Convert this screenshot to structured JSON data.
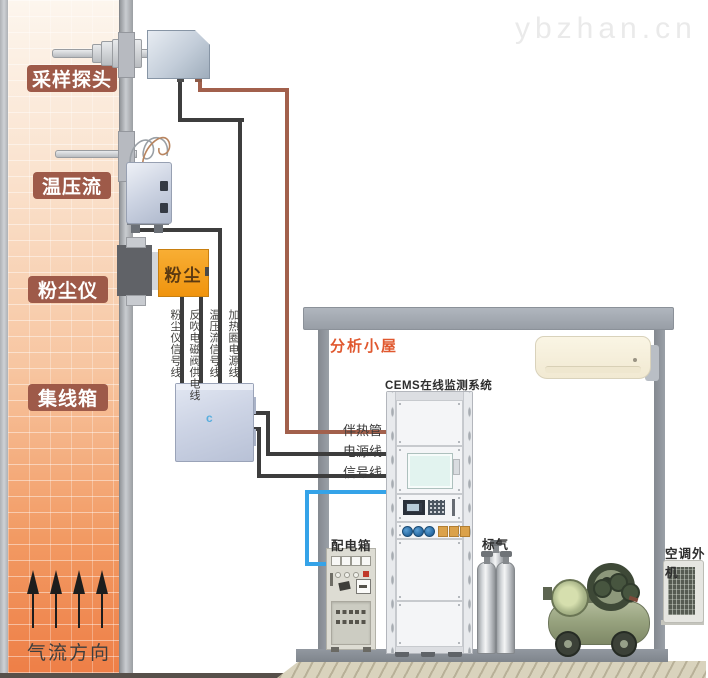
{
  "watermark": "ybzhan.cn",
  "stack_labels": {
    "sampling_probe": "采样探头",
    "temp_pressure_flow": "温压流",
    "dust_meter": "粉尘仪",
    "junction_box": "集线箱",
    "airflow": "气流方向"
  },
  "device_texts": {
    "dust_meter_face": "粉尘",
    "junction_box_mark": "c"
  },
  "cable_labels": {
    "dust_signal": "粉尘仪信号线",
    "blowback_valve_power": "反吹电磁阀供电线",
    "tpf_signal": "温压流信号线",
    "heating_coil_power": "加热圈电源线",
    "heat_traced_tube": "伴热管",
    "power_line": "电源线",
    "signal_line": "信号线"
  },
  "shelter": {
    "title": "分析小屋",
    "cems_system": "CEMS在线监测系统",
    "distribution_box": "配电箱",
    "standard_gas": "标气",
    "ac_outdoor_unit": "空调外机"
  },
  "colors": {
    "wire_dark": "#3d3d3d",
    "wire_heat_traced": "#a2604c",
    "wire_blue": "#35a3e8",
    "stack_label_bg": "#9e5a49",
    "shelter_title": "#e0582f",
    "dust_device_orange": "#f0940e"
  }
}
